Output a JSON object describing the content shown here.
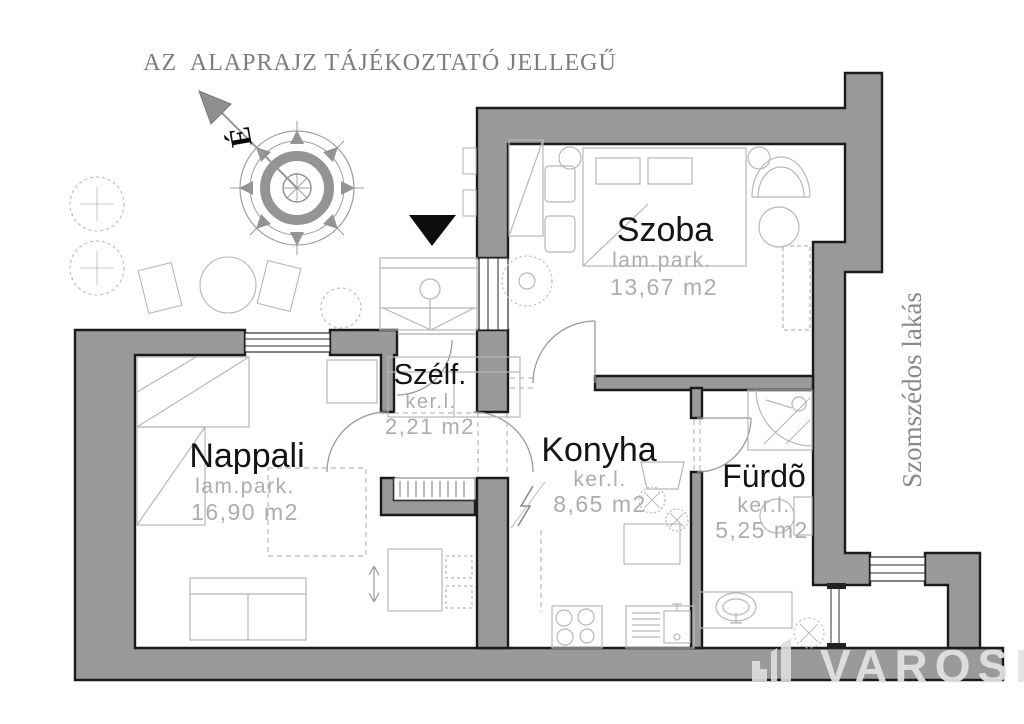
{
  "title": "AZ  ALAPRAJZ TÁJÉKOZTATÓ JELLEGŰ",
  "compass": {
    "north_label": "É"
  },
  "rooms": {
    "szoba": {
      "name": "Szoba",
      "floor": "lam.park.",
      "area": "13,67  m2"
    },
    "nappali": {
      "name": "Nappali",
      "floor": "lam.park.",
      "area": "16,90  m2"
    },
    "szelf": {
      "name": "Szélf.",
      "floor": "ker.l.",
      "area": "2,21  m2"
    },
    "konyha": {
      "name": "Konyha",
      "floor": "ker.l.",
      "area": "8,65  m2"
    },
    "furdo": {
      "name": "Fürdõ",
      "floor": "ker.l.",
      "area": "5,25  m2"
    }
  },
  "neighbor_label": "Szomszédos lakás",
  "watermark": {
    "brand": "VAROSI"
  },
  "colors": {
    "wall": "#9a9a9a",
    "wall_outline": "#1b1b1b",
    "room_label": "#141414",
    "sub_label": "#adadad",
    "title": "#7d7d7d",
    "furniture_line": "#b8b8b8",
    "watermark": "#e3e3e3",
    "entrance_marker": "#0d0d0d"
  }
}
